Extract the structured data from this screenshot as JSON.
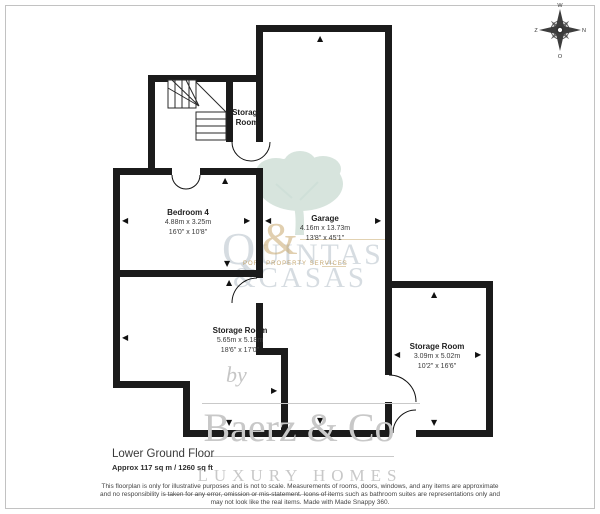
{
  "floorplan": {
    "rooms": [
      {
        "name": "Storage Room"
      },
      {
        "name": "Bedroom 4",
        "metric": "4.88m x 3.25m",
        "imperial": "16'0\" x 10'8\""
      },
      {
        "name": "Garage",
        "metric": "4.16m x 13.73m",
        "imperial": "13'8\" x 45'1\""
      },
      {
        "name": "Storage Room",
        "metric": "5.65m x 5.18m",
        "imperial": "18'6\" x 17'0\""
      },
      {
        "name": "Storage Room",
        "metric": "3.09m x 5.02m",
        "imperial": "10'2\" x 16'6\""
      }
    ],
    "footer": {
      "title": "Lower Ground Floor",
      "area": "Approx 117 sq m / 1260 sq ft"
    },
    "compass": {
      "top": "W",
      "right": "N",
      "bottom": "O",
      "left": "Z"
    },
    "disclaimer": {
      "line1": "This floorplan is only for illustrative purposes and is not to scale. Measurements of rooms, doors, windows, and any items are approximate",
      "line2": "and no responsibility is taken for any error, omission or mis-statement. Icons of items such as bathroom suites are representations only and",
      "line3": "may not look like the real items. Made with Made Snappy 360."
    },
    "watermarks": {
      "agency_logo": {
        "line1": "QUINTAS",
        "ampersand": "&",
        "line2": "&CASAS",
        "tagline": "PORT PROPERTY SERVICES"
      },
      "brand": {
        "by": "by",
        "name": "Baerz & Co",
        "subtitle": "LUXURY HOMES"
      }
    },
    "colors": {
      "wall": "#1b1b1b",
      "watermark_gray": "#c8c8c8",
      "logo_gold": "#c3a05f",
      "logo_pale_blue": "#8296a5",
      "tree_green": "#b7cfc3"
    }
  }
}
